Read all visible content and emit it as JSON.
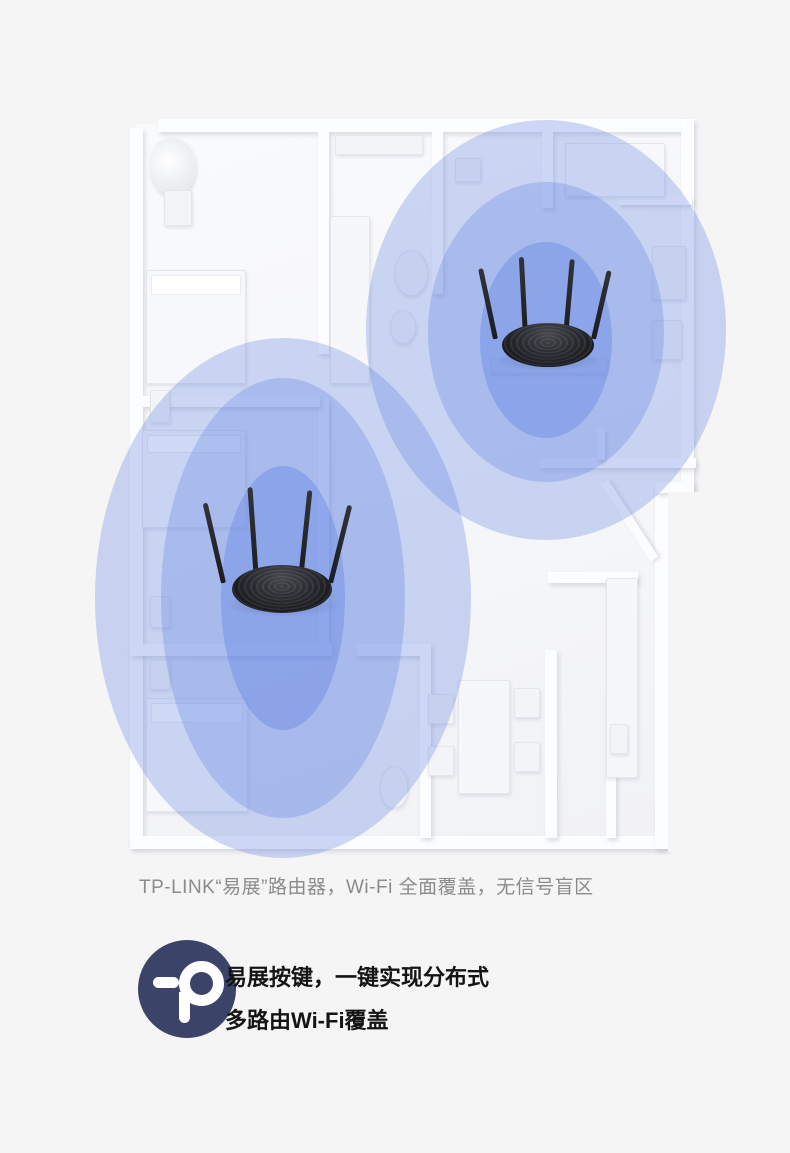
{
  "page": {
    "background": "#f5f5f6"
  },
  "caption": {
    "text": "TP-LINK“易展”路由器，Wi-Fi 全面覆盖，无信号盲区"
  },
  "feature": {
    "line1": "易展按键，一键实现分布式",
    "line2": "多路由Wi-Fi覆盖",
    "logo_color": "#3b4468"
  },
  "illustration": {
    "accent_blue": "#5f82e1",
    "coverage": [
      {
        "name": "coverage-outer-router-1",
        "cx": 283,
        "cy": 598,
        "rx": 188,
        "ry": 260,
        "alpha": 0.3
      },
      {
        "name": "coverage-outer-router-2",
        "cx": 546,
        "cy": 330,
        "rx": 180,
        "ry": 210,
        "alpha": 0.3
      },
      {
        "name": "coverage-middle-router-1",
        "cx": 283,
        "cy": 598,
        "rx": 122,
        "ry": 220,
        "alpha": 0.3
      },
      {
        "name": "coverage-middle-router-2",
        "cx": 546,
        "cy": 332,
        "rx": 118,
        "ry": 150,
        "alpha": 0.3
      },
      {
        "name": "coverage-inner-router-1",
        "cx": 283,
        "cy": 598,
        "rx": 62,
        "ry": 132,
        "alpha": 0.38
      },
      {
        "name": "coverage-inner-router-2",
        "cx": 546,
        "cy": 340,
        "rx": 66,
        "ry": 98,
        "alpha": 0.38
      }
    ],
    "walls": [
      [
        158,
        119,
        532,
        13
      ],
      [
        130,
        128,
        13,
        718
      ],
      [
        130,
        836,
        536,
        13
      ],
      [
        681,
        119,
        13,
        372
      ],
      [
        655,
        482,
        13,
        367
      ],
      [
        655,
        482,
        39,
        11
      ],
      [
        318,
        132,
        11,
        222
      ],
      [
        318,
        398,
        11,
        250
      ],
      [
        143,
        396,
        177,
        11
      ],
      [
        130,
        644,
        202,
        12
      ],
      [
        357,
        644,
        74,
        12
      ],
      [
        432,
        132,
        11,
        162
      ],
      [
        542,
        132,
        11,
        76
      ],
      [
        618,
        196,
        74,
        9
      ],
      [
        540,
        458,
        156,
        10
      ],
      [
        597,
        428,
        8,
        32
      ],
      [
        545,
        650,
        12,
        188
      ],
      [
        606,
        688,
        10,
        150
      ],
      [
        548,
        572,
        90,
        11
      ],
      [
        420,
        655,
        11,
        183
      ]
    ],
    "furniture": [
      {
        "t": "plant",
        "x": 150,
        "y": 138,
        "w": 46,
        "h": 58
      },
      {
        "t": "pot",
        "x": 164,
        "y": 190,
        "w": 28,
        "h": 36
      },
      {
        "t": "bed",
        "x": 146,
        "y": 270,
        "w": 100,
        "h": 114
      },
      {
        "t": "pillow",
        "x": 151,
        "y": 275,
        "w": 90,
        "h": 20
      },
      {
        "t": "stand",
        "x": 150,
        "y": 390,
        "w": 20,
        "h": 33
      },
      {
        "t": "cabinet",
        "x": 335,
        "y": 135,
        "w": 88,
        "h": 20
      },
      {
        "t": "sofa",
        "x": 330,
        "y": 216,
        "w": 40,
        "h": 168
      },
      {
        "t": "round",
        "x": 394,
        "y": 250,
        "w": 34,
        "h": 46
      },
      {
        "t": "round",
        "x": 390,
        "y": 310,
        "w": 26,
        "h": 34
      },
      {
        "t": "ac",
        "x": 455,
        "y": 158,
        "w": 26,
        "h": 24
      },
      {
        "t": "bed",
        "x": 142,
        "y": 430,
        "w": 104,
        "h": 98
      },
      {
        "t": "pillow",
        "x": 147,
        "y": 435,
        "w": 94,
        "h": 18
      },
      {
        "t": "stand",
        "x": 150,
        "y": 596,
        "w": 20,
        "h": 32
      },
      {
        "t": "bed",
        "x": 146,
        "y": 698,
        "w": 102,
        "h": 114
      },
      {
        "t": "pillow",
        "x": 151,
        "y": 703,
        "w": 92,
        "h": 20
      },
      {
        "t": "stand",
        "x": 150,
        "y": 660,
        "w": 20,
        "h": 30
      },
      {
        "t": "sideboard",
        "x": 490,
        "y": 358,
        "w": 118,
        "h": 16
      },
      {
        "t": "bed",
        "x": 565,
        "y": 143,
        "w": 100,
        "h": 54
      },
      {
        "t": "dresser",
        "x": 652,
        "y": 246,
        "w": 34,
        "h": 54
      },
      {
        "t": "dresser",
        "x": 652,
        "y": 320,
        "w": 30,
        "h": 40
      },
      {
        "t": "table",
        "x": 458,
        "y": 680,
        "w": 52,
        "h": 114
      },
      {
        "t": "chair",
        "x": 428,
        "y": 694,
        "w": 26,
        "h": 30
      },
      {
        "t": "chair",
        "x": 428,
        "y": 746,
        "w": 26,
        "h": 30
      },
      {
        "t": "chair",
        "x": 514,
        "y": 688,
        "w": 26,
        "h": 30
      },
      {
        "t": "chair",
        "x": 514,
        "y": 742,
        "w": 26,
        "h": 30
      },
      {
        "t": "toilet",
        "x": 380,
        "y": 766,
        "w": 28,
        "h": 42
      },
      {
        "t": "counter",
        "x": 606,
        "y": 578,
        "w": 32,
        "h": 200
      },
      {
        "t": "stand",
        "x": 610,
        "y": 724,
        "w": 18,
        "h": 30
      }
    ]
  }
}
